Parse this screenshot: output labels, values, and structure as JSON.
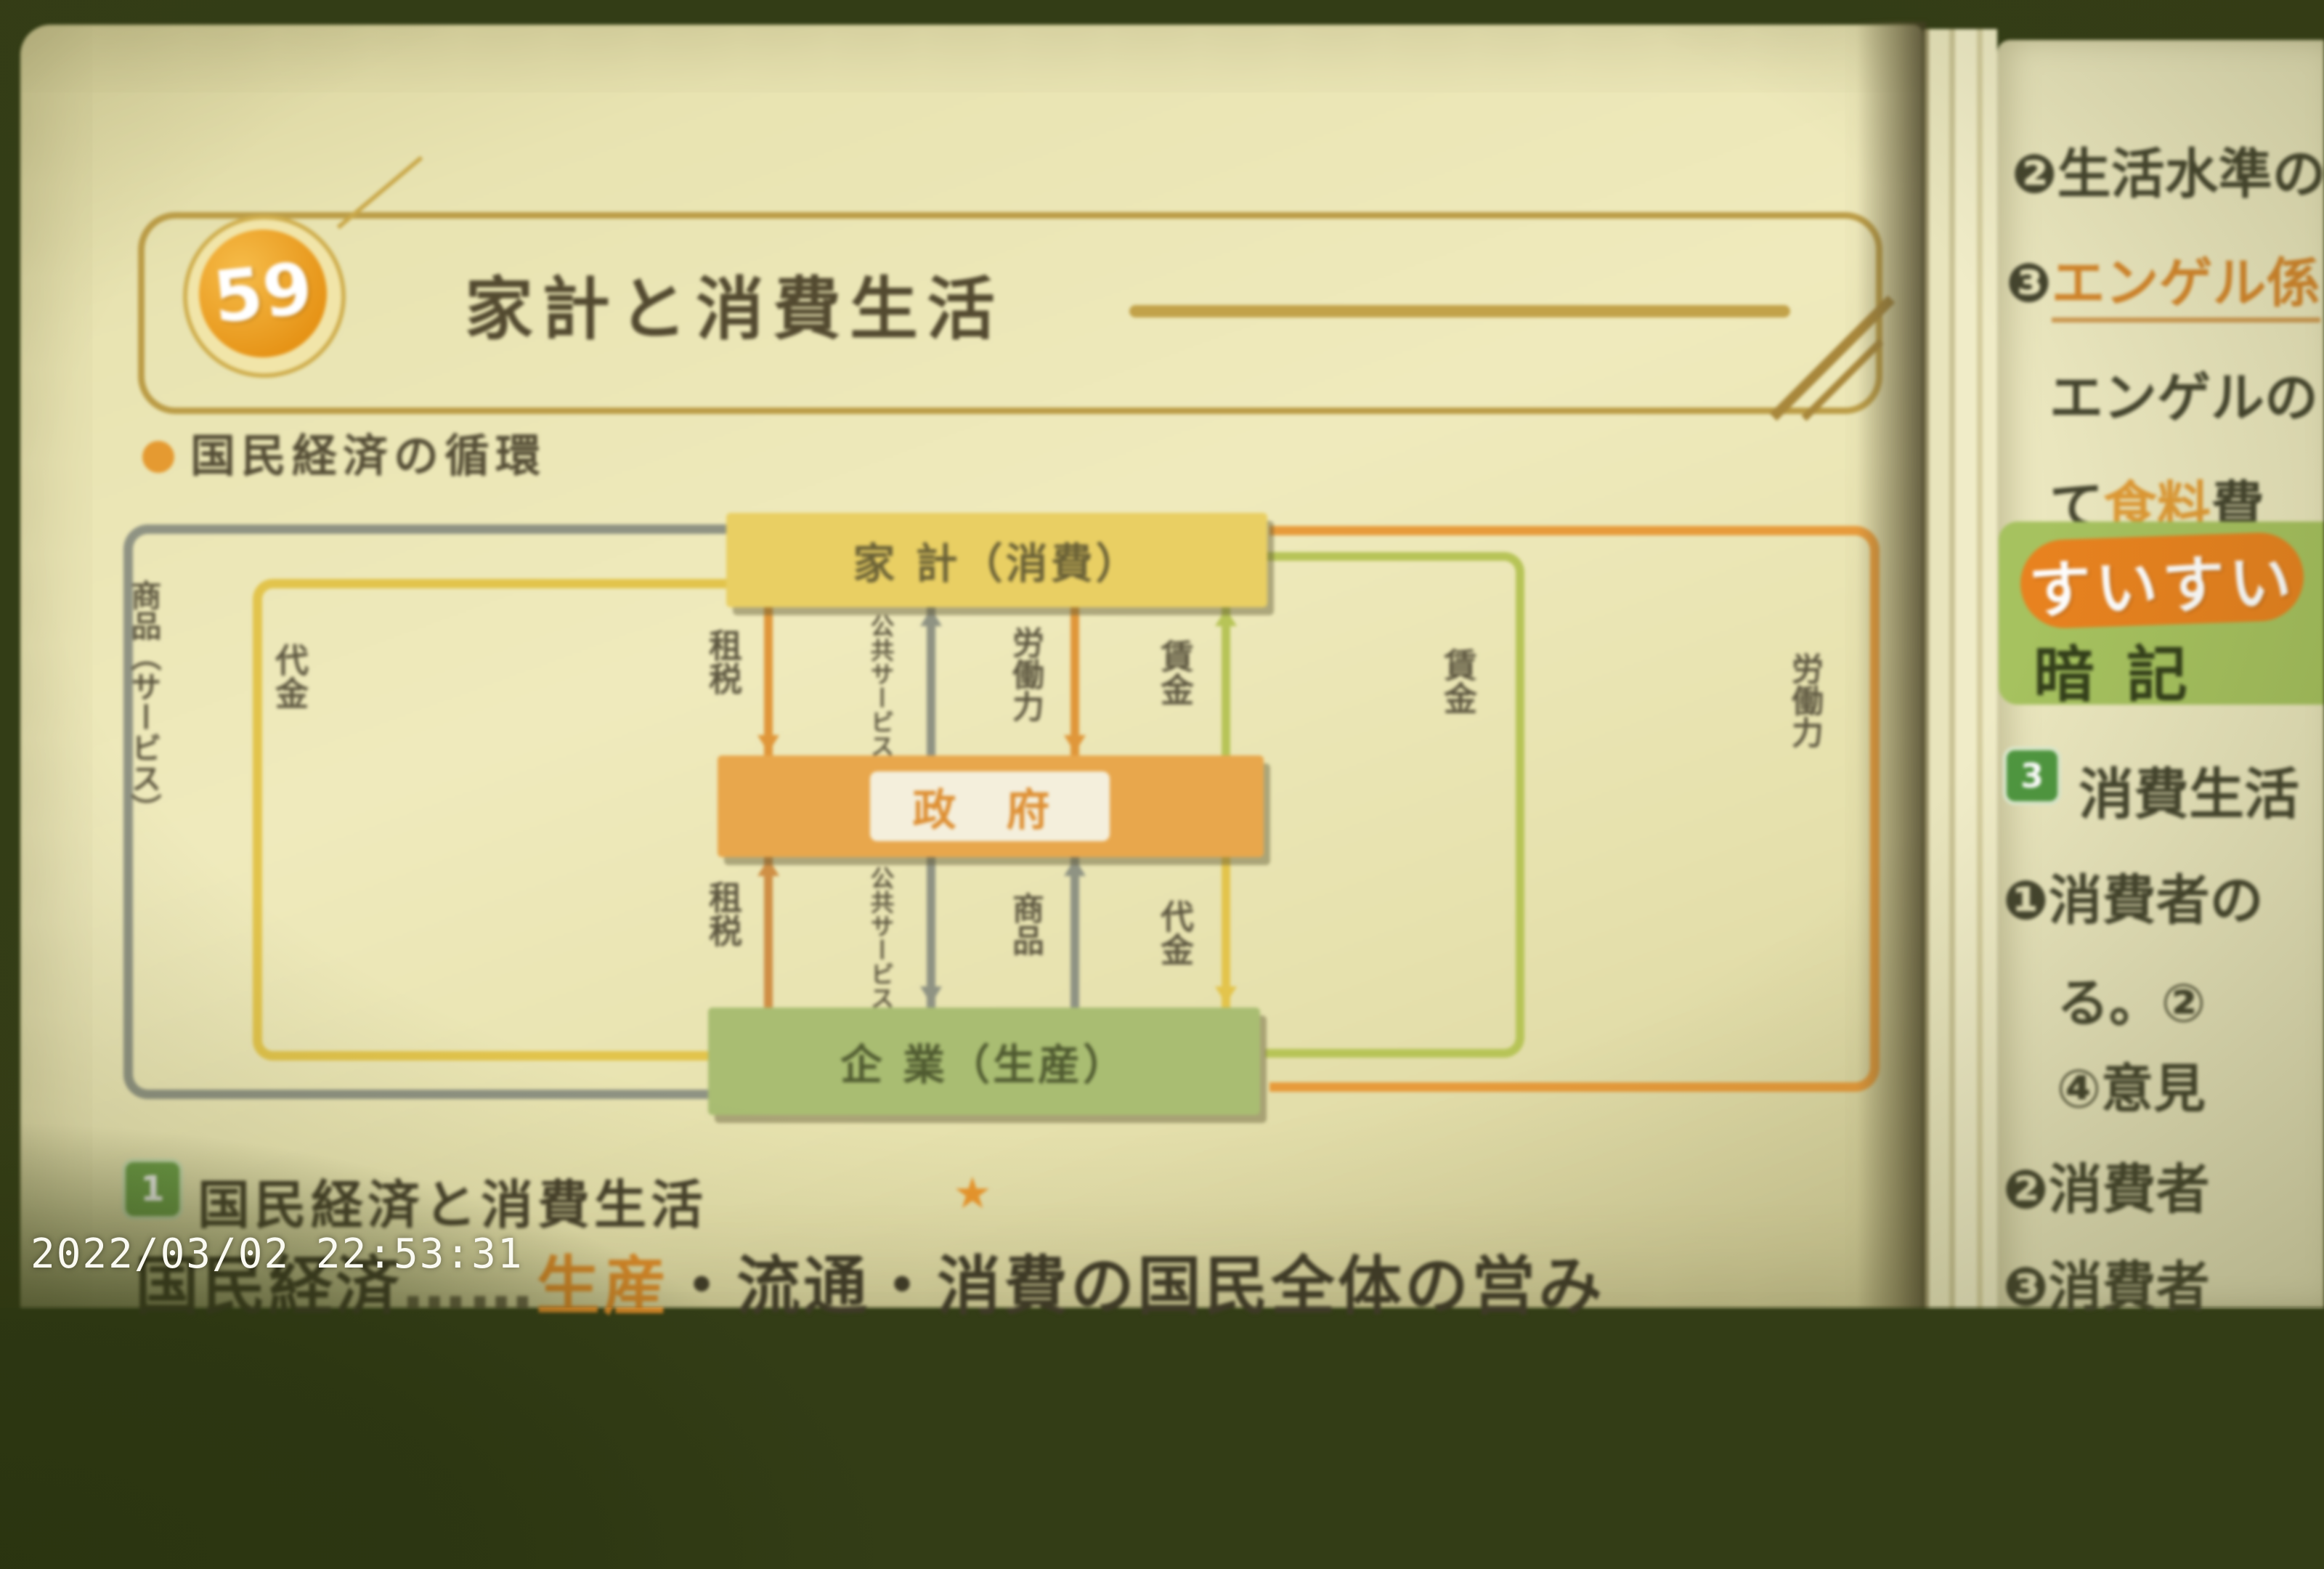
{
  "photo": {
    "timestamp": "2022/03/02 22:53:31"
  },
  "left_page": {
    "lesson_number": "59",
    "title": "家計と消費生活",
    "section1_heading": "国民経済の循環",
    "diagram": {
      "top_box": "家 計（消費）",
      "middle_box": "政 府",
      "bottom_box": "企 業（生産）",
      "left_outer_loop_label": "商品（サービス）",
      "left_inner_loop_label": "代金",
      "right_inner_loop_label": "賃金",
      "right_outer_loop_label": "労働力",
      "upper_flows": [
        {
          "label": "租税",
          "direction": "down"
        },
        {
          "label": "公共サービス",
          "direction": "up"
        },
        {
          "label": "労働力",
          "direction": "down"
        },
        {
          "label": "賃金",
          "direction": "up"
        }
      ],
      "lower_flows": [
        {
          "label": "租税",
          "direction": "up"
        },
        {
          "label": "公共サービス",
          "direction": "down"
        },
        {
          "label": "商品",
          "direction": "up"
        },
        {
          "label": "代金",
          "direction": "down"
        }
      ]
    },
    "section2": {
      "badge": "1",
      "heading": "国民経済と消費生活",
      "star": "★",
      "body_pre": "国民経済",
      "body_dots": "……",
      "body_keyword": "生産",
      "body_post": "・流通・消費の国民全体の営み"
    }
  },
  "right_page": {
    "line1": "❷生活水準の",
    "line2_prefix": "❸",
    "line2_keyword": "エンゲル係",
    "line3": "エンゲルの",
    "line4_pre": "て",
    "line4_highlight": "食料",
    "line4_post": "費",
    "memory_badge_top": "すいすい",
    "memory_badge_bottom": "暗記",
    "section3_badge": "3",
    "section3_heading": "消費生活",
    "item1": "❶消費者の",
    "item1_cont1": "る。②",
    "item1_cont2": "④意見",
    "item2": "❷消費者",
    "item3": "❸消費者"
  }
}
